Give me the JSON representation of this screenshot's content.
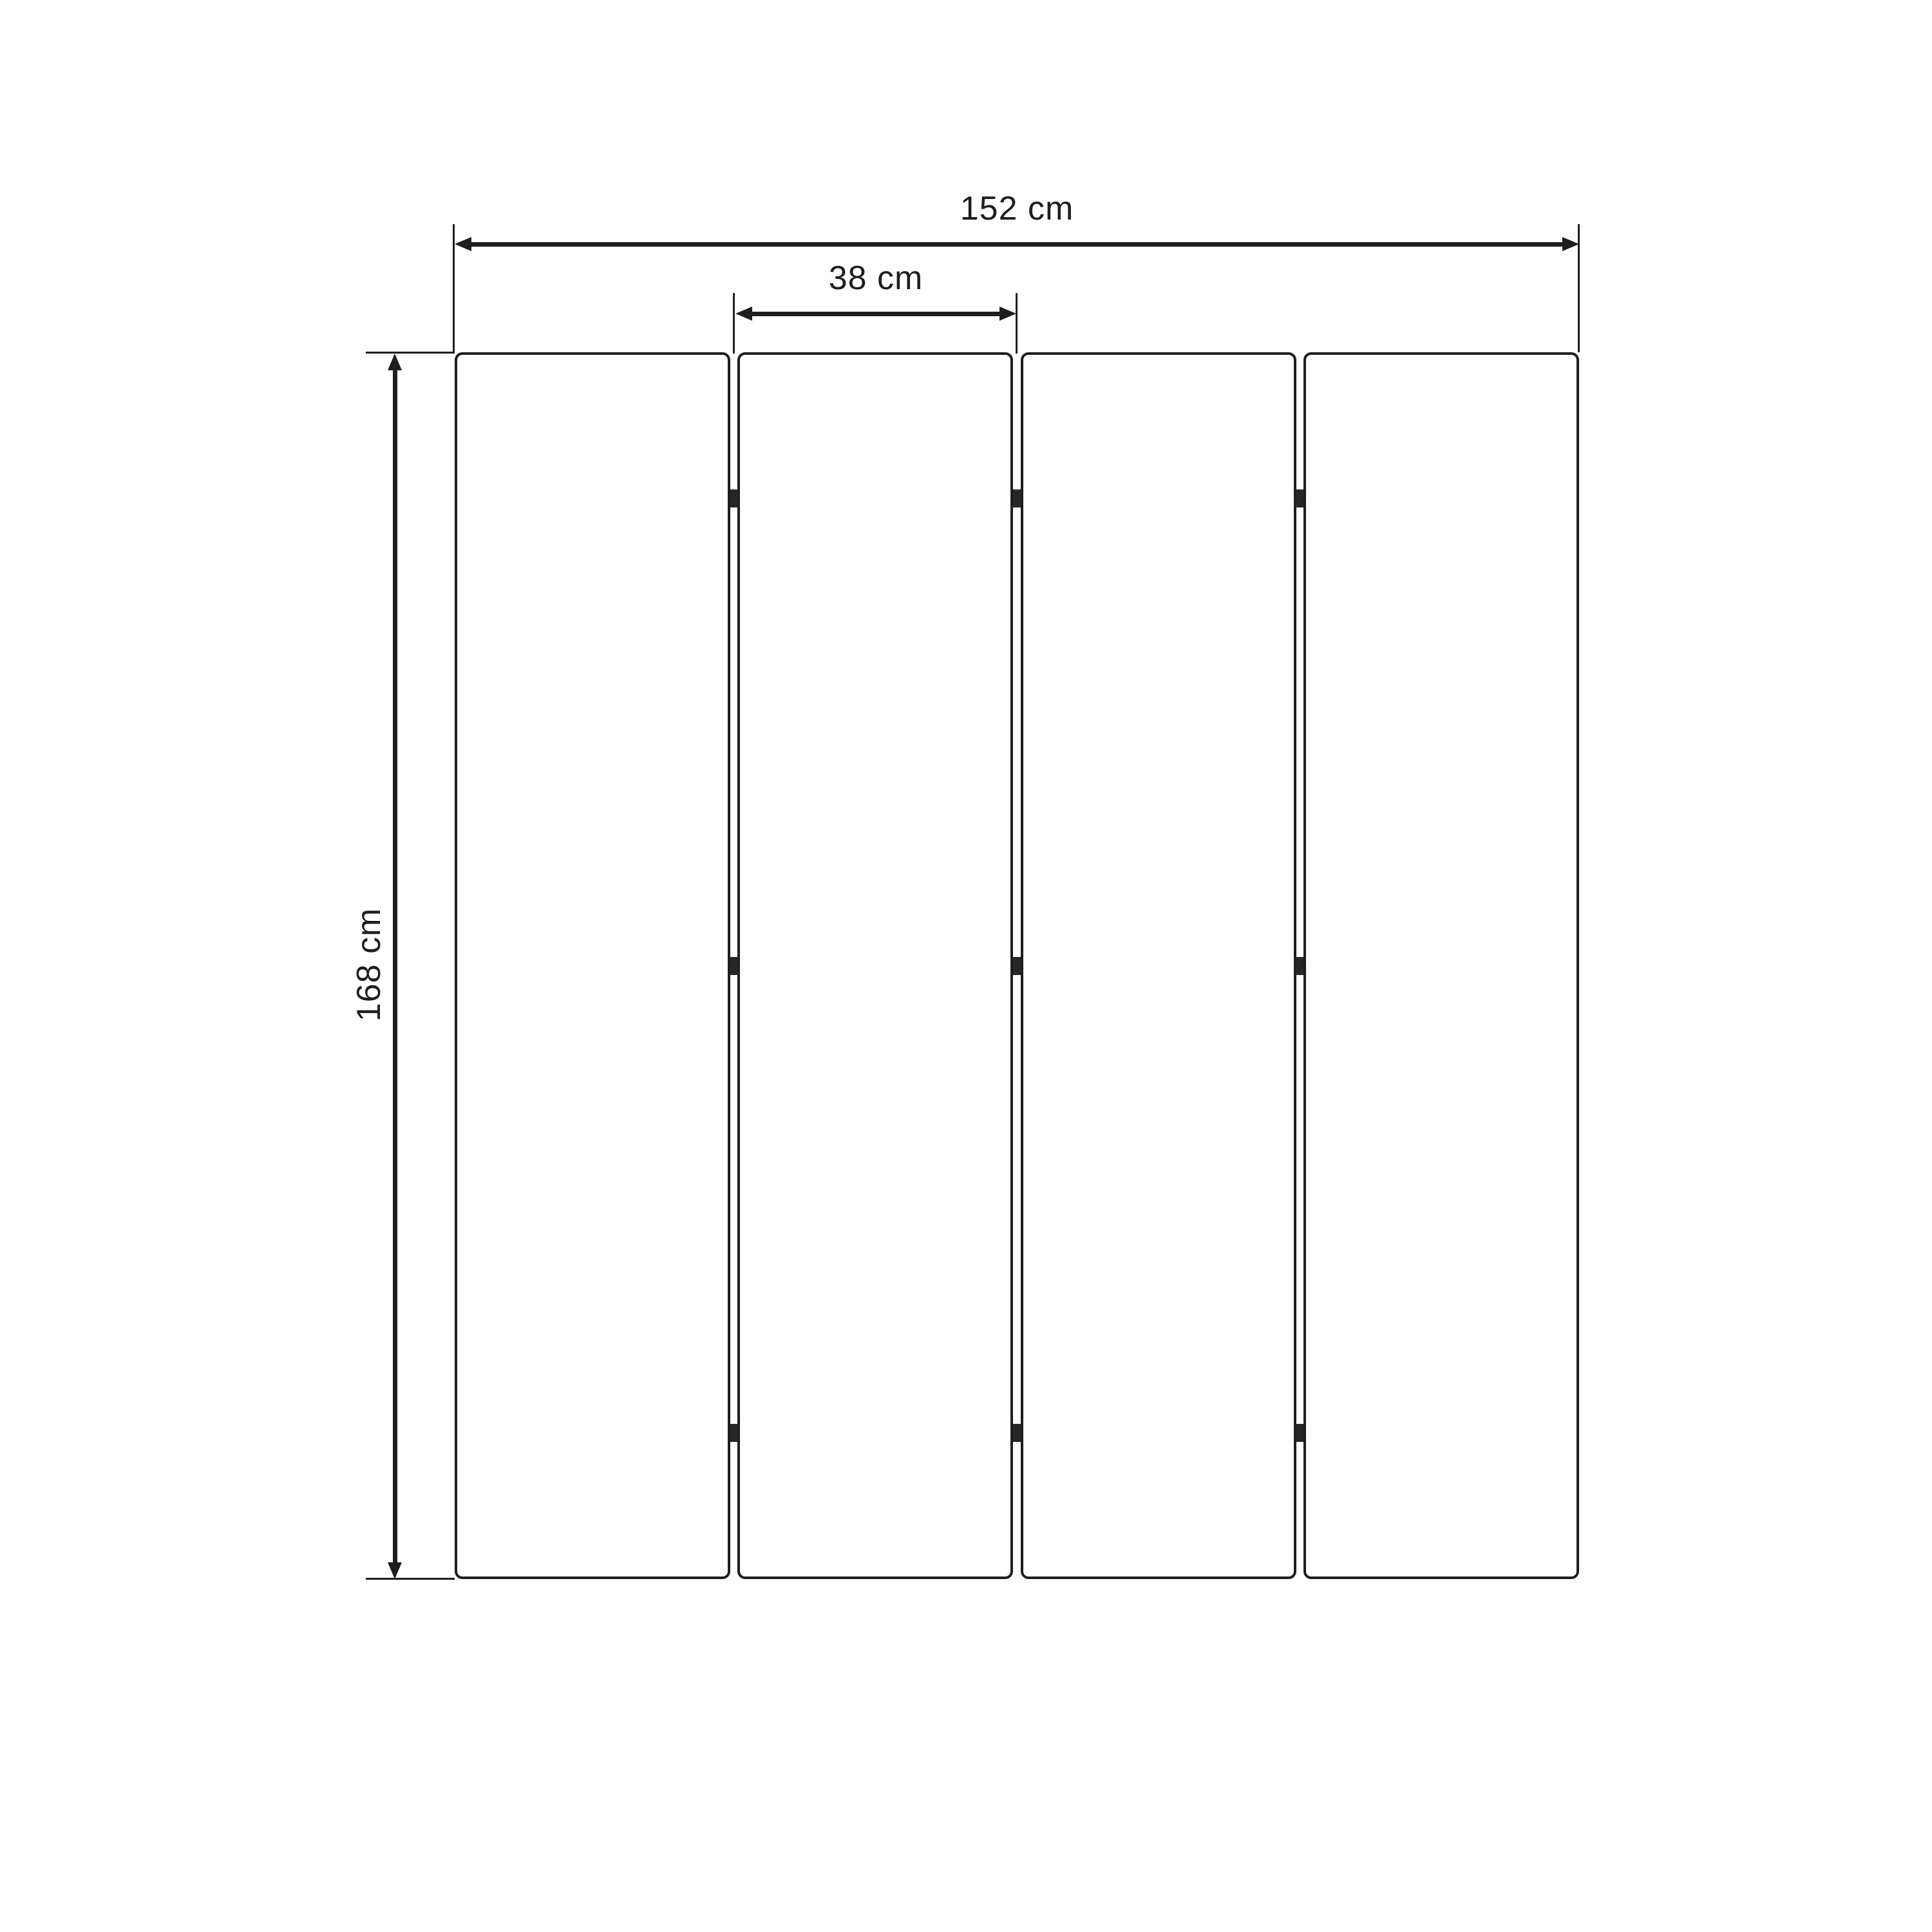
{
  "diagram": {
    "type": "product-dimension-drawing",
    "subject": "four-panel folding screen (room divider), front view",
    "overall_width_label": "152 cm",
    "panel_width_label": "38 cm",
    "height_label": "168 cm",
    "panel_count": 4,
    "hinge_rows": 3,
    "hinges_per_junction": 3,
    "colors": {
      "background": "#ffffff",
      "line": "#1e1e1e",
      "hinge": "#262626"
    }
  }
}
